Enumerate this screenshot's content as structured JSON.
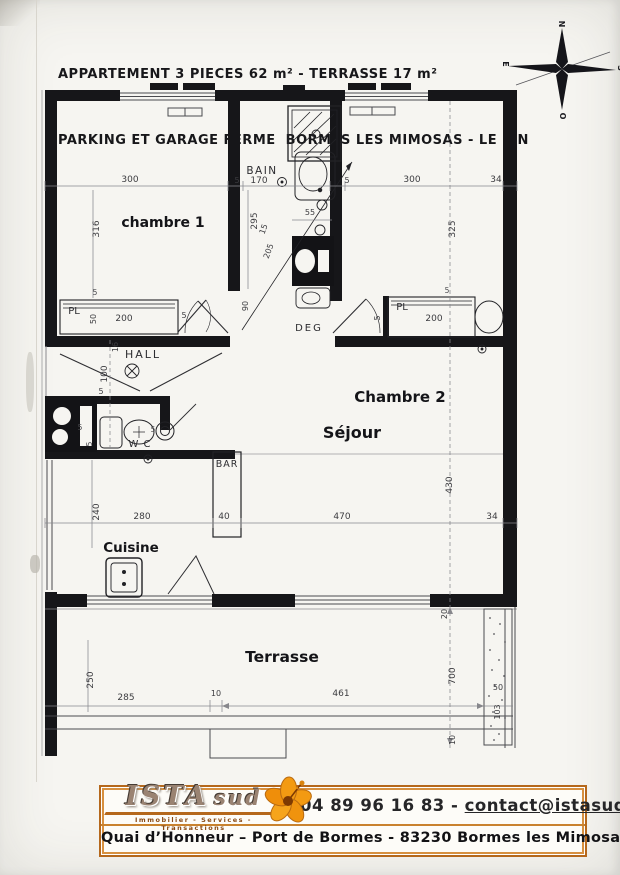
{
  "header": {
    "line1": "APPARTEMENT 3 PIECES 62 m² - TERRASSE 17 m²",
    "line2": "PARKING ET GARAGE FERME  BORMES LES MIMOSAS - LE PIN"
  },
  "compass": {
    "north": "N",
    "east": "E",
    "south": "S",
    "west": "O"
  },
  "plan": {
    "rooms": {
      "chambre1": "chambre 1",
      "chambre2": "Chambre 2",
      "bain": "BAIN",
      "deg": "DEG",
      "hall": "HALL",
      "wc": "W C",
      "sejour": "Séjour",
      "bar": "BAR",
      "cuisine": "Cuisine",
      "terrasse": "Terrasse",
      "placard1": "PL",
      "placard2": "PL"
    },
    "dims_top": {
      "c1_width": "300",
      "wall_a": "5",
      "bain_width": "170",
      "wall_b": "5",
      "c2_width": "300",
      "wall_right": "34"
    },
    "dims_vertical": {
      "c1_depth": "316",
      "bain_depth": "295",
      "c2_depth": "325",
      "bain_diag": "205",
      "bain_diag2": "15",
      "basin_width": "55",
      "door_c1": "90",
      "hall_height": "100",
      "hall_wall": "16",
      "hall_5": "5",
      "wc_5a": "5",
      "wc_5b": "5",
      "wc_5c": "5",
      "kitchen_height": "240",
      "sejour_depth": "430",
      "wall_20": "20",
      "total_height": "700",
      "edge_10": "10"
    },
    "dims_mid": {
      "kitchen_width": "280",
      "bar_width": "40",
      "sejour_width": "470",
      "wall_right": "34"
    },
    "dims_pl1": {
      "depth_50": "50",
      "width_200": "200",
      "wall_5": "5",
      "wall_5b": "5"
    },
    "dims_pl2": {
      "width_200": "200",
      "wall_5": "5",
      "wall_5b": "5"
    },
    "dims_terrace": {
      "depth": "250",
      "left": "285",
      "gap": "10",
      "front": "461",
      "planter_width": "50",
      "planter_depth": "103"
    }
  },
  "footer": {
    "brand_main": "ISTA",
    "brand_sub": "sud",
    "tagline": "Immobilier - Services - Transactions",
    "phone": "04 89 96 16 83",
    "separator": "-",
    "email": "contact@istasud.com",
    "address": "Quai d’Honneur – Port de Bormes - 83230 Bormes les Mimosas"
  }
}
